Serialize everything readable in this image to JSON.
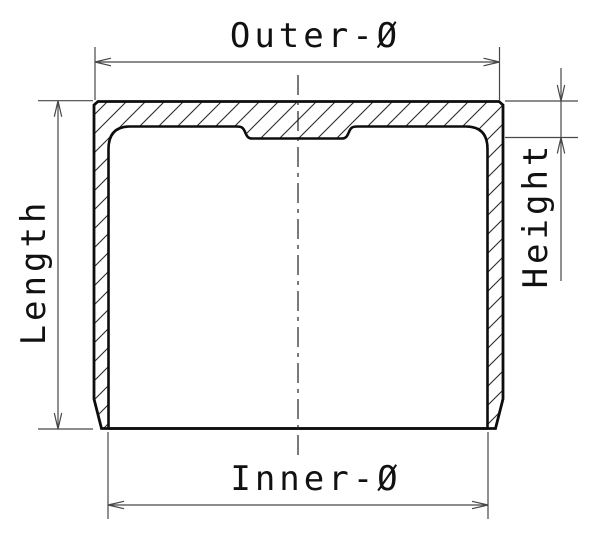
{
  "title": "Valve tappet cross-section technical drawing",
  "drawing": {
    "labels": {
      "outer_diameter": "Outer-Ø",
      "inner_diameter": "Inner-Ø",
      "length": "Length",
      "height": "Height"
    },
    "colors": {
      "background": "#ffffff",
      "part_outline": "#0d0d0d",
      "hatching": "#2a2a2a",
      "dimension_lines": "#474747",
      "label_text": "#111111"
    }
  }
}
